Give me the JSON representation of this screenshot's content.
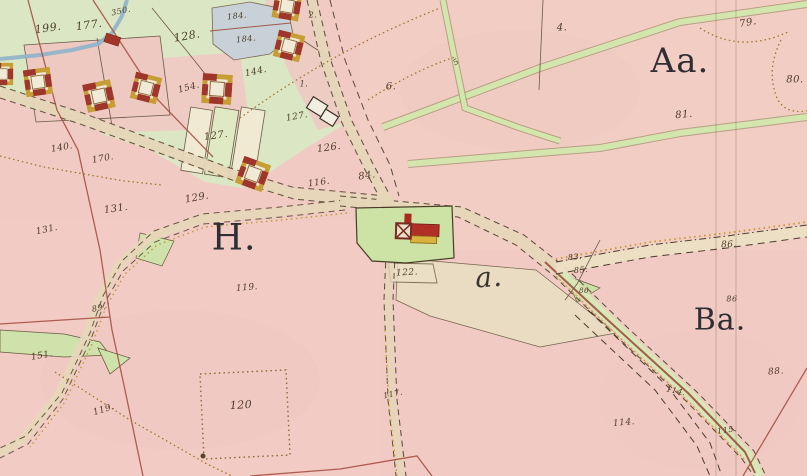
{
  "map": {
    "title": "historical hand-drawn cadastral map sheet",
    "colors": {
      "field_pink": "#f0cac3",
      "village_green": "#dbe7c4",
      "road_strip_green": "#cfe3ab",
      "road_tan": "#e6d6b8",
      "water_blue": "#8fb3ca",
      "pond_grey_blue": "#c7d1d7",
      "building_red": "#a93325",
      "building_yellow": "#cfa438",
      "ink_sepia": "#5a4632",
      "boundary_red": "#a34a3c",
      "dotted_ochre": "#a0742c"
    },
    "symbols": {
      "farmstead": "square courtyard farm drawn with red and yellow border",
      "outbuilding": "small solid red rectangle",
      "unpainted_building": "small white rectangle with dark outline",
      "main_farm": "long red building with yellow wing on green plot"
    },
    "labels": {
      "areas": [
        {
          "text": "Aa.",
          "x": 680,
          "y": 61,
          "fs": 34,
          "rot": 0,
          "italic": false
        },
        {
          "text": "H.",
          "x": 234,
          "y": 238,
          "fs": 36,
          "rot": 0,
          "italic": false
        },
        {
          "text": "Ba.",
          "x": 720,
          "y": 320,
          "fs": 30,
          "rot": 0,
          "italic": false
        },
        {
          "text": "a.",
          "x": 489,
          "y": 277,
          "fs": 28,
          "rot": -4,
          "italic": true
        }
      ],
      "parcels": [
        {
          "text": "199.",
          "x": 48,
          "y": 28,
          "rot": -8,
          "fs": 11
        },
        {
          "text": "177.",
          "x": 89,
          "y": 25,
          "rot": -8,
          "fs": 11
        },
        {
          "text": "128.",
          "x": 187,
          "y": 36,
          "rot": -10,
          "fs": 11
        },
        {
          "text": "184.",
          "x": 237,
          "y": 16,
          "rot": -6,
          "fs": 8
        },
        {
          "text": "184.",
          "x": 246,
          "y": 39,
          "rot": -6,
          "fs": 8
        },
        {
          "text": "144.",
          "x": 256,
          "y": 72,
          "rot": -12,
          "fs": 9
        },
        {
          "text": "154.",
          "x": 189,
          "y": 88,
          "rot": -15,
          "fs": 9
        },
        {
          "text": "127.",
          "x": 216,
          "y": 136,
          "rot": -8,
          "fs": 10
        },
        {
          "text": "127.",
          "x": 297,
          "y": 117,
          "rot": -10,
          "fs": 9
        },
        {
          "text": "126.",
          "x": 329,
          "y": 148,
          "rot": -8,
          "fs": 10
        },
        {
          "text": "116.",
          "x": 319,
          "y": 183,
          "rot": -8,
          "fs": 9
        },
        {
          "text": "84.",
          "x": 367,
          "y": 176,
          "rot": -8,
          "fs": 10
        },
        {
          "text": "2.",
          "x": 313,
          "y": 15,
          "rot": 0,
          "fs": 8
        },
        {
          "text": "1.",
          "x": 304,
          "y": 84,
          "rot": 0,
          "fs": 8
        },
        {
          "text": "6.",
          "x": 391,
          "y": 87,
          "rot": 0,
          "fs": 10
        },
        {
          "text": "5",
          "x": 456,
          "y": 62,
          "rot": -30,
          "fs": 8
        },
        {
          "text": "4.",
          "x": 562,
          "y": 28,
          "rot": 0,
          "fs": 10
        },
        {
          "text": "79.",
          "x": 748,
          "y": 23,
          "rot": -10,
          "fs": 10
        },
        {
          "text": "80.",
          "x": 795,
          "y": 80,
          "rot": 0,
          "fs": 10
        },
        {
          "text": "81.",
          "x": 684,
          "y": 115,
          "rot": -5,
          "fs": 10
        },
        {
          "text": "350.",
          "x": 121,
          "y": 11,
          "rot": -12,
          "fs": 8
        },
        {
          "text": "140.",
          "x": 62,
          "y": 148,
          "rot": -10,
          "fs": 9
        },
        {
          "text": "170.",
          "x": 103,
          "y": 159,
          "rot": -10,
          "fs": 9
        },
        {
          "text": "131.",
          "x": 116,
          "y": 209,
          "rot": -8,
          "fs": 10
        },
        {
          "text": "131.",
          "x": 47,
          "y": 230,
          "rot": -12,
          "fs": 9
        },
        {
          "text": "129.",
          "x": 197,
          "y": 198,
          "rot": -10,
          "fs": 10
        },
        {
          "text": "119.",
          "x": 247,
          "y": 288,
          "rot": -5,
          "fs": 9
        },
        {
          "text": "89.",
          "x": 99,
          "y": 308,
          "rot": -12,
          "fs": 8
        },
        {
          "text": "119.",
          "x": 104,
          "y": 410,
          "rot": -18,
          "fs": 9
        },
        {
          "text": "120",
          "x": 241,
          "y": 405,
          "rot": -3,
          "fs": 11
        },
        {
          "text": "151.",
          "x": 42,
          "y": 356,
          "rot": -10,
          "fs": 9
        },
        {
          "text": "122.",
          "x": 407,
          "y": 273,
          "rot": -3,
          "fs": 9
        },
        {
          "text": "117.",
          "x": 393,
          "y": 394,
          "rot": -12,
          "fs": 8
        },
        {
          "text": "83.",
          "x": 575,
          "y": 257,
          "rot": -5,
          "fs": 8
        },
        {
          "text": "85.",
          "x": 581,
          "y": 270,
          "rot": -5,
          "fs": 8
        },
        {
          "text": "86.",
          "x": 729,
          "y": 245,
          "rot": -3,
          "fs": 9
        },
        {
          "text": "86",
          "x": 732,
          "y": 299,
          "rot": 0,
          "fs": 8
        },
        {
          "text": "86",
          "x": 584,
          "y": 291,
          "rot": 0,
          "fs": 7
        },
        {
          "text": "88.",
          "x": 776,
          "y": 372,
          "rot": -5,
          "fs": 9
        },
        {
          "text": "114.",
          "x": 676,
          "y": 391,
          "rot": 12,
          "fs": 8
        },
        {
          "text": "114.",
          "x": 624,
          "y": 423,
          "rot": -5,
          "fs": 9
        },
        {
          "text": "115.",
          "x": 727,
          "y": 430,
          "rot": -8,
          "fs": 8
        }
      ]
    }
  }
}
